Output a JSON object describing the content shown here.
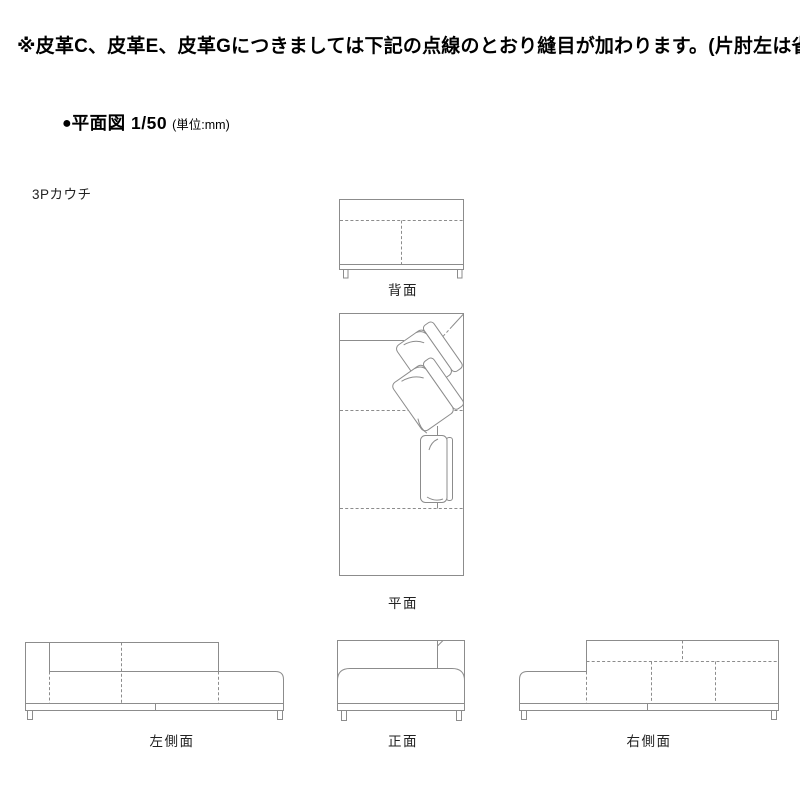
{
  "note": "※皮革C、皮革E、皮革Gにつきましては下記の点線のとおり縫目が加わります。(片肘左は省略)",
  "section": {
    "bullet": "●",
    "title": "平面図 1/50",
    "unit": "(単位:mm)"
  },
  "product_label": "3Pカウチ",
  "views": {
    "back": "背面",
    "plan": "平面",
    "left_side": "左側面",
    "front": "正面",
    "right_side": "右側面"
  },
  "scale": "1/50",
  "unit_value": "mm",
  "colors": {
    "background": "#ffffff",
    "line": "#8c8c8c",
    "text": "#1a1a1a"
  }
}
